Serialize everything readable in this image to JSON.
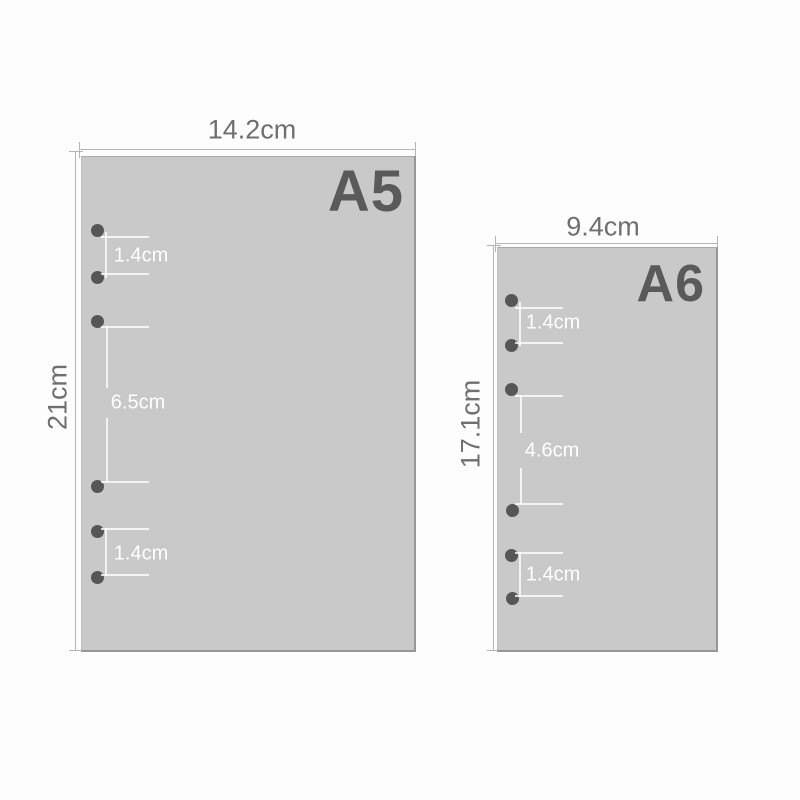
{
  "title": "Loose-leaf paper size diagram",
  "a5": {
    "name": "A5",
    "width": "14.2cm",
    "height": "21cm",
    "hole_count": 6,
    "hole_gap_top": "1.4cm",
    "hole_gap_middle": "6.5cm",
    "hole_gap_bottom": "1.4cm"
  },
  "a6": {
    "name": "A6",
    "width": "9.4cm",
    "height": "17.1cm",
    "hole_count": 6,
    "hole_gap_top": "1.4cm",
    "hole_gap_middle": "4.6cm",
    "hole_gap_bottom": "1.4cm"
  },
  "colors": {
    "background": "#fdfdfd",
    "sheet_fill": "#c9c9c9",
    "sheet_edge": "#979797",
    "sheet_label_text": "#5a5a5a",
    "hole": "#565656",
    "dimension_line": "#b5b5b5",
    "dimension_text": "#6f6f6f",
    "annotation_text": "#ffffff"
  }
}
